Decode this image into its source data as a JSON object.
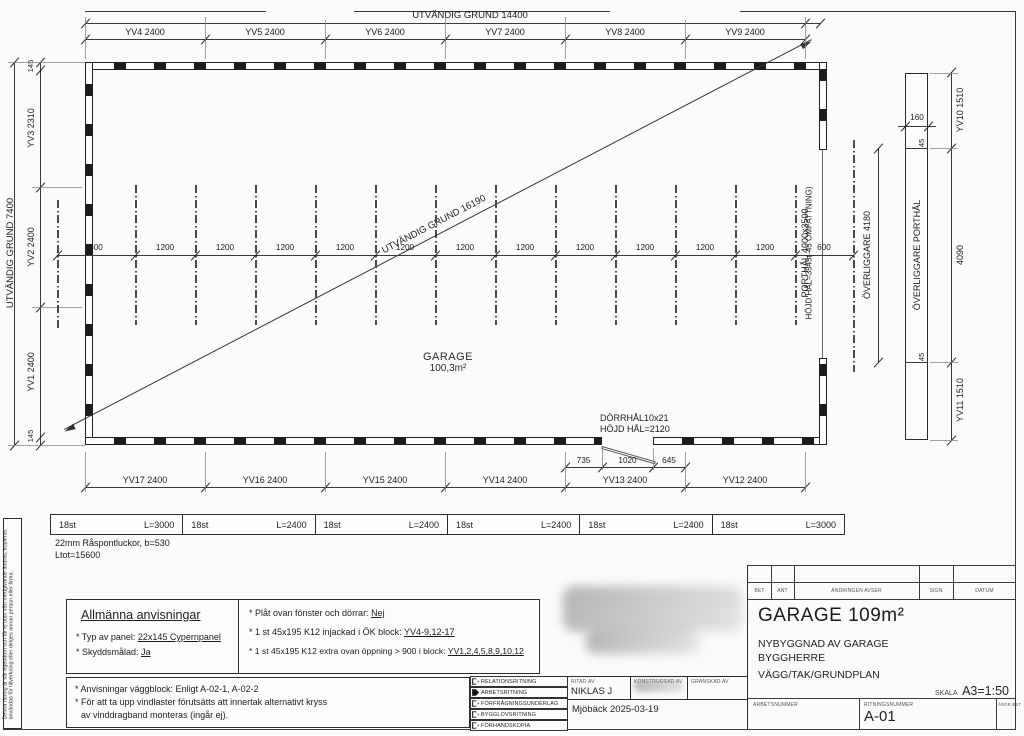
{
  "sheet": {
    "disclaimer": "Denna ritning är vår egendom och får ej utan vårt medgivande ändras, kopieras, användas för tillverkning eller delges annan person eller firma."
  },
  "plan": {
    "top_overall": "UTVÄNDIG GRUND 14400",
    "top_dims": [
      "YV4 2400",
      "YV5 2400",
      "YV6 2400",
      "YV7 2400",
      "YV8 2400",
      "YV9 2400"
    ],
    "left_overall": "UTVÄNDIG GRUND 7400",
    "left_corner_top": "145",
    "left_corner_bottom": "145",
    "left_dims": [
      "YV3 2310",
      "YV2 2400",
      "YV1 2400"
    ],
    "diagonal_label": "UTVÄNDIG GRUND 16190",
    "room_name": "GARAGE",
    "room_area": "100,3m²",
    "module_dims": [
      "600",
      "1200",
      "1200",
      "1200",
      "1200",
      "1200",
      "1200",
      "1200",
      "1200",
      "1200",
      "1200",
      "1200",
      "600"
    ],
    "bottom_dims": [
      "YV17 2400",
      "YV16 2400",
      "YV15 2400",
      "YV14 2400",
      "YV13 2400",
      "YV12 2400"
    ],
    "door_dims": [
      "735",
      "1020",
      "645"
    ],
    "door_label1": "DÖRRHÅL10x21",
    "door_label2": "HÖJD HÅL=2120",
    "porthal_label": "PORTHÅL 4000x3500",
    "porthal_height": "HÖJD HÅL=3545(-45 OMFATTNING)",
    "overliggare_dim": "ÖVERLIGGARE 4180",
    "overliggare_label": "ÖVERLIGGARE PORTHÅL",
    "overliggare_width": "160",
    "overliggare_end_top": "45",
    "overliggare_end_bottom": "45",
    "right_dims": [
      "YV10 1510",
      "4090",
      "YV11 1510"
    ]
  },
  "materials": {
    "cells": [
      {
        "qty": "18st",
        "len": "L=3000"
      },
      {
        "qty": "18st",
        "len": "L=2400"
      },
      {
        "qty": "18st",
        "len": "L=2400"
      },
      {
        "qty": "18st",
        "len": "L=2400"
      },
      {
        "qty": "18st",
        "len": "L=2400"
      },
      {
        "qty": "18st",
        "len": "L=3000"
      }
    ],
    "note1": "22mm Råspontluckor, b=530",
    "note2": "Ltot=15600"
  },
  "notes": {
    "title": "Allmänna anvisningar",
    "left": [
      {
        "label": "* Typ av panel: ",
        "value": "22x145 Cypernpanel"
      },
      {
        "label": "* Skyddsmålad: ",
        "value": "Ja"
      }
    ],
    "right": [
      {
        "label": "* Plåt ovan fönster och dörrar: ",
        "value": "Nej"
      },
      {
        "label": "* 1 st 45x195 K12 injackad i ÖK block: ",
        "value": "YV4-9,12-17"
      },
      {
        "label": "* 1 st 45x195 K12 extra ovan öppning > 900 i block: ",
        "value": "YV1,2,4,5,8,9,10,12"
      }
    ],
    "box2_lines": [
      "* Anvisningar väggblock: Enligt A-02-1, A-02-2",
      "* För att ta upp vindlaster förutsätts att innertak alternativt kryss",
      "av vinddragband monteras (ingår ej)."
    ]
  },
  "status_list": {
    "items": [
      "RELATIONSRITNING",
      "ARBETSRITNING",
      "FÖRFRÅGNINGSUNDERLAG",
      "BYGGLOVSRITNING",
      "FÖRHANDSKOPIA"
    ],
    "selected_index": 1
  },
  "stamp": {
    "ritad_av_label": "RITAD AV",
    "ritad_av": "NIKLAS J",
    "konstruerad_av_label": "KONSTRUERAD AV",
    "granskad_av_label": "GRANSKAD AV",
    "place_date": "Mjöbäck 2025-03-19"
  },
  "titleblock": {
    "rev_headers": [
      "BET",
      "ANT",
      "ÄNDRINGEN AVSER",
      "SIGN",
      "DATUM"
    ],
    "title": "GARAGE 109m²",
    "line1": "NYBYGGNAD AV GARAGE",
    "line2": "BYGGHERRE",
    "line3": "VÄGG/TAK/GRUNDPLAN",
    "scale_label": "SKALA",
    "scale_value": "A3=1:50",
    "arbetsnummer_label": "ARBETSNUMMER",
    "ritningsnummer_label": "RITNINGSNUMMER",
    "drawing_number": "A-01",
    "andr_bet_label": "ÄNDR.BET"
  }
}
